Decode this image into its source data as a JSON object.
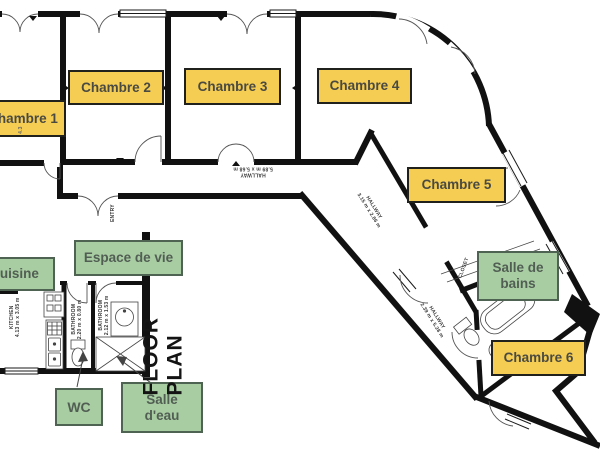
{
  "title": {
    "floor_plan": "FLOOR PLAN"
  },
  "colors": {
    "chambre_bg": "#F5CD53",
    "chambre_border": "#20201c",
    "chambre_text": "#4a4a42",
    "zone_bg": "#A9CDA3",
    "zone_border": "#4f6352",
    "zone_text": "#515e53",
    "wall": "#111111"
  },
  "room_labels": {
    "chambre1": "Chambre 1",
    "chambre2": "Chambre 2",
    "chambre3": "Chambre 3",
    "chambre4": "Chambre 4",
    "chambre5": "Chambre 5",
    "chambre6": "Chambre 6",
    "cuisine": "Cuisine",
    "espace_de_vie": "Espace de vie",
    "wc": "WC",
    "salle_eau": "Salle\nd'eau",
    "salle_de_bains": "Salle de\nbains"
  },
  "annotations": {
    "hallway_main": "HALLWAY\n5.89 m x 5.68 m",
    "hallway_diag1": "HALLWAY\n3.15 m x 2.86 m",
    "hallway_diag2": "HALLWAY\n2.39 m x 5.28 m",
    "entry": "ENTRY",
    "closet": "CLOSET",
    "kitchen": "KITCHEN\n4.13 m x 3.05 m",
    "bathroom_wc": "BATHROOM\n2.20 m x 0.80 m",
    "bathroom_eau": "BATHROOM\n2.12 m x 1.53 m",
    "dim_ch1": "4.3"
  }
}
